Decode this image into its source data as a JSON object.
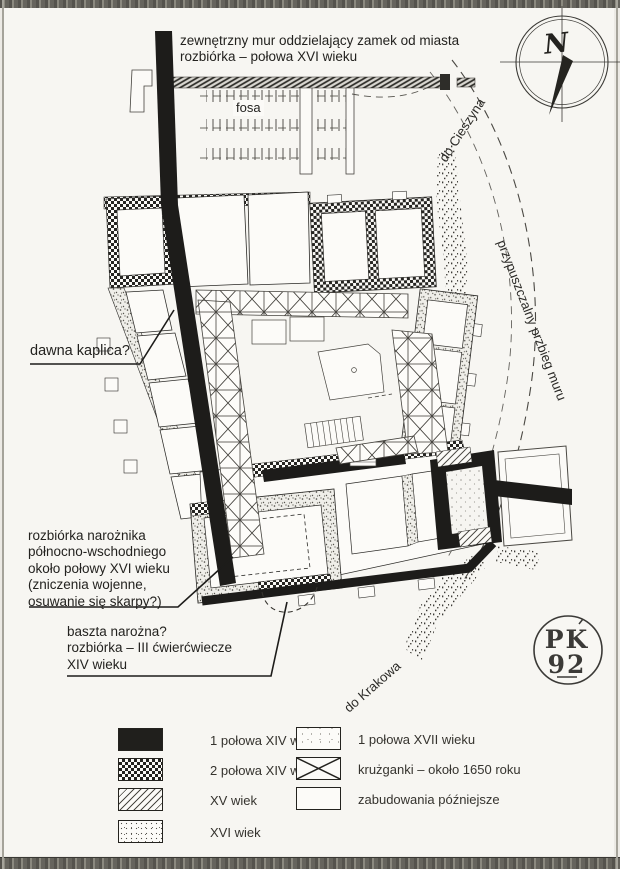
{
  "plan": {
    "labels": {
      "outer_wall": "zewnętrzny mur oddzielający zamek od miasta\nrozbiórka – połowa XVI wieku",
      "fosa": "fosa",
      "kaplica": "dawna kaplica?",
      "rozbiorka_narozhnika": "rozbiórka narożnika\npółnocno-wschodniego\nokoło połowy XVI wieku\n(zniczenia wojenne,\nosuwanie się skarpy?)",
      "baszta": "baszta narożna?\nrozbiórka – III ćwierćwiecze\nXIV wieku",
      "do_cieszyna": "do Cieszyna",
      "przebieg_muru": "przypuszczalny przbieg muru",
      "do_krakowa": "do Krakowa"
    },
    "compass": {
      "letter": "N"
    },
    "stamp": {
      "line1": "PK",
      "line2": "92"
    }
  },
  "legend": {
    "left": [
      {
        "swatch": "solid-black",
        "label": "1 połowa XIV wieku"
      },
      {
        "swatch": "checker",
        "label": "2 połowa XIV wieku"
      },
      {
        "swatch": "diagonal-hatch",
        "label": "XV wiek"
      },
      {
        "swatch": "stipple",
        "label": "XVI wiek"
      }
    ],
    "right": [
      {
        "swatch": "stipple-light",
        "label": "1 połowa XVII wieku"
      },
      {
        "swatch": "x-cross",
        "label": "krużganki – około 1650 roku"
      },
      {
        "swatch": "outline",
        "label": "zabudowania późniejsze"
      }
    ]
  },
  "colors": {
    "ink": "#2b2a27",
    "wall_black": "#1d1c1a",
    "paper": "#f7f6f2"
  }
}
